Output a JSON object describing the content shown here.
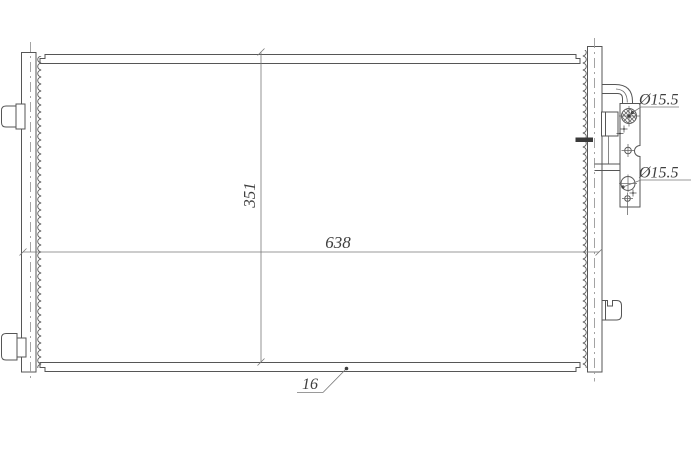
{
  "drawing": {
    "type": "condenser-technical-drawing",
    "dimensions": {
      "core_height": "351",
      "core_width": "638",
      "core_thickness": "16",
      "top_port_diameter": "Ø15.5",
      "bottom_port_diameter": "Ø15.5"
    },
    "colors": {
      "background": "#ffffff",
      "line": "#565656",
      "centerline": "#9a9a9a",
      "dimension_line": "#787878",
      "text": "#3f3f3f"
    }
  }
}
